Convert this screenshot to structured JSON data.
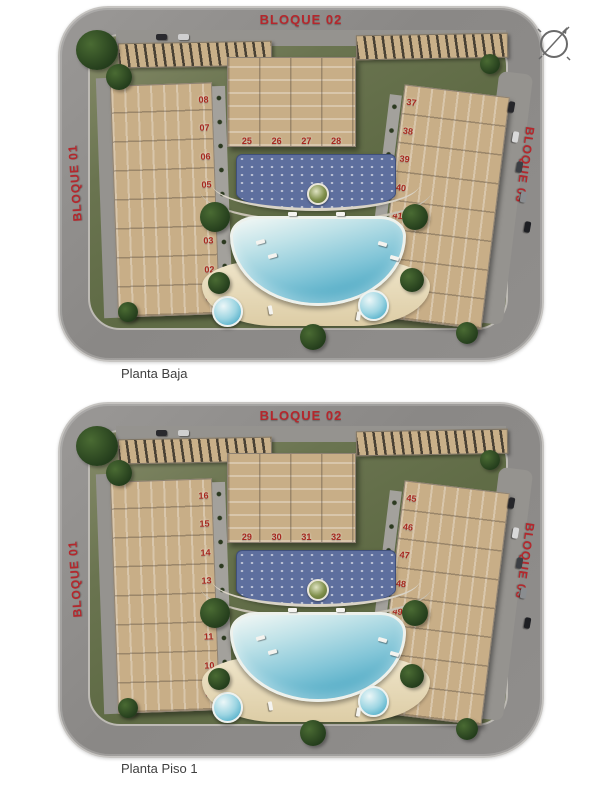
{
  "colors": {
    "block_label_red": "#b5272c",
    "unit_number_red": "#a8291f",
    "road_gray": "#8e8c8a",
    "lawn_green": "#626e47",
    "building_tan": "#c8ae87",
    "pool_blue": "#6fbcd4",
    "deck_blue": "#5e6f9e",
    "sand_beige": "#e7dcc0"
  },
  "icons": {
    "compass": "compass-rose-icon"
  },
  "plans": [
    {
      "caption": "Planta Baja",
      "labels": {
        "top": "BLOQUE 02",
        "left": "BLOQUE 01",
        "right": "BLOQUE 03"
      },
      "left_units": [
        "08",
        "07",
        "06",
        "05",
        "04",
        "03",
        "02",
        "01"
      ],
      "center_units": [
        "25",
        "26",
        "27",
        "28"
      ],
      "right_units": [
        "37",
        "38",
        "39",
        "40",
        "41",
        "42",
        "43",
        "44"
      ]
    },
    {
      "caption": "Planta Piso 1",
      "labels": {
        "top": "BLOQUE 02",
        "left": "BLOQUE 01",
        "right": "BLOQUE 03"
      },
      "left_units": [
        "16",
        "15",
        "14",
        "13",
        "12",
        "11",
        "10",
        "09"
      ],
      "center_units": [
        "29",
        "30",
        "31",
        "32"
      ],
      "right_units": [
        "45",
        "46",
        "47",
        "48",
        "49",
        "50",
        "51",
        "52"
      ]
    }
  ]
}
